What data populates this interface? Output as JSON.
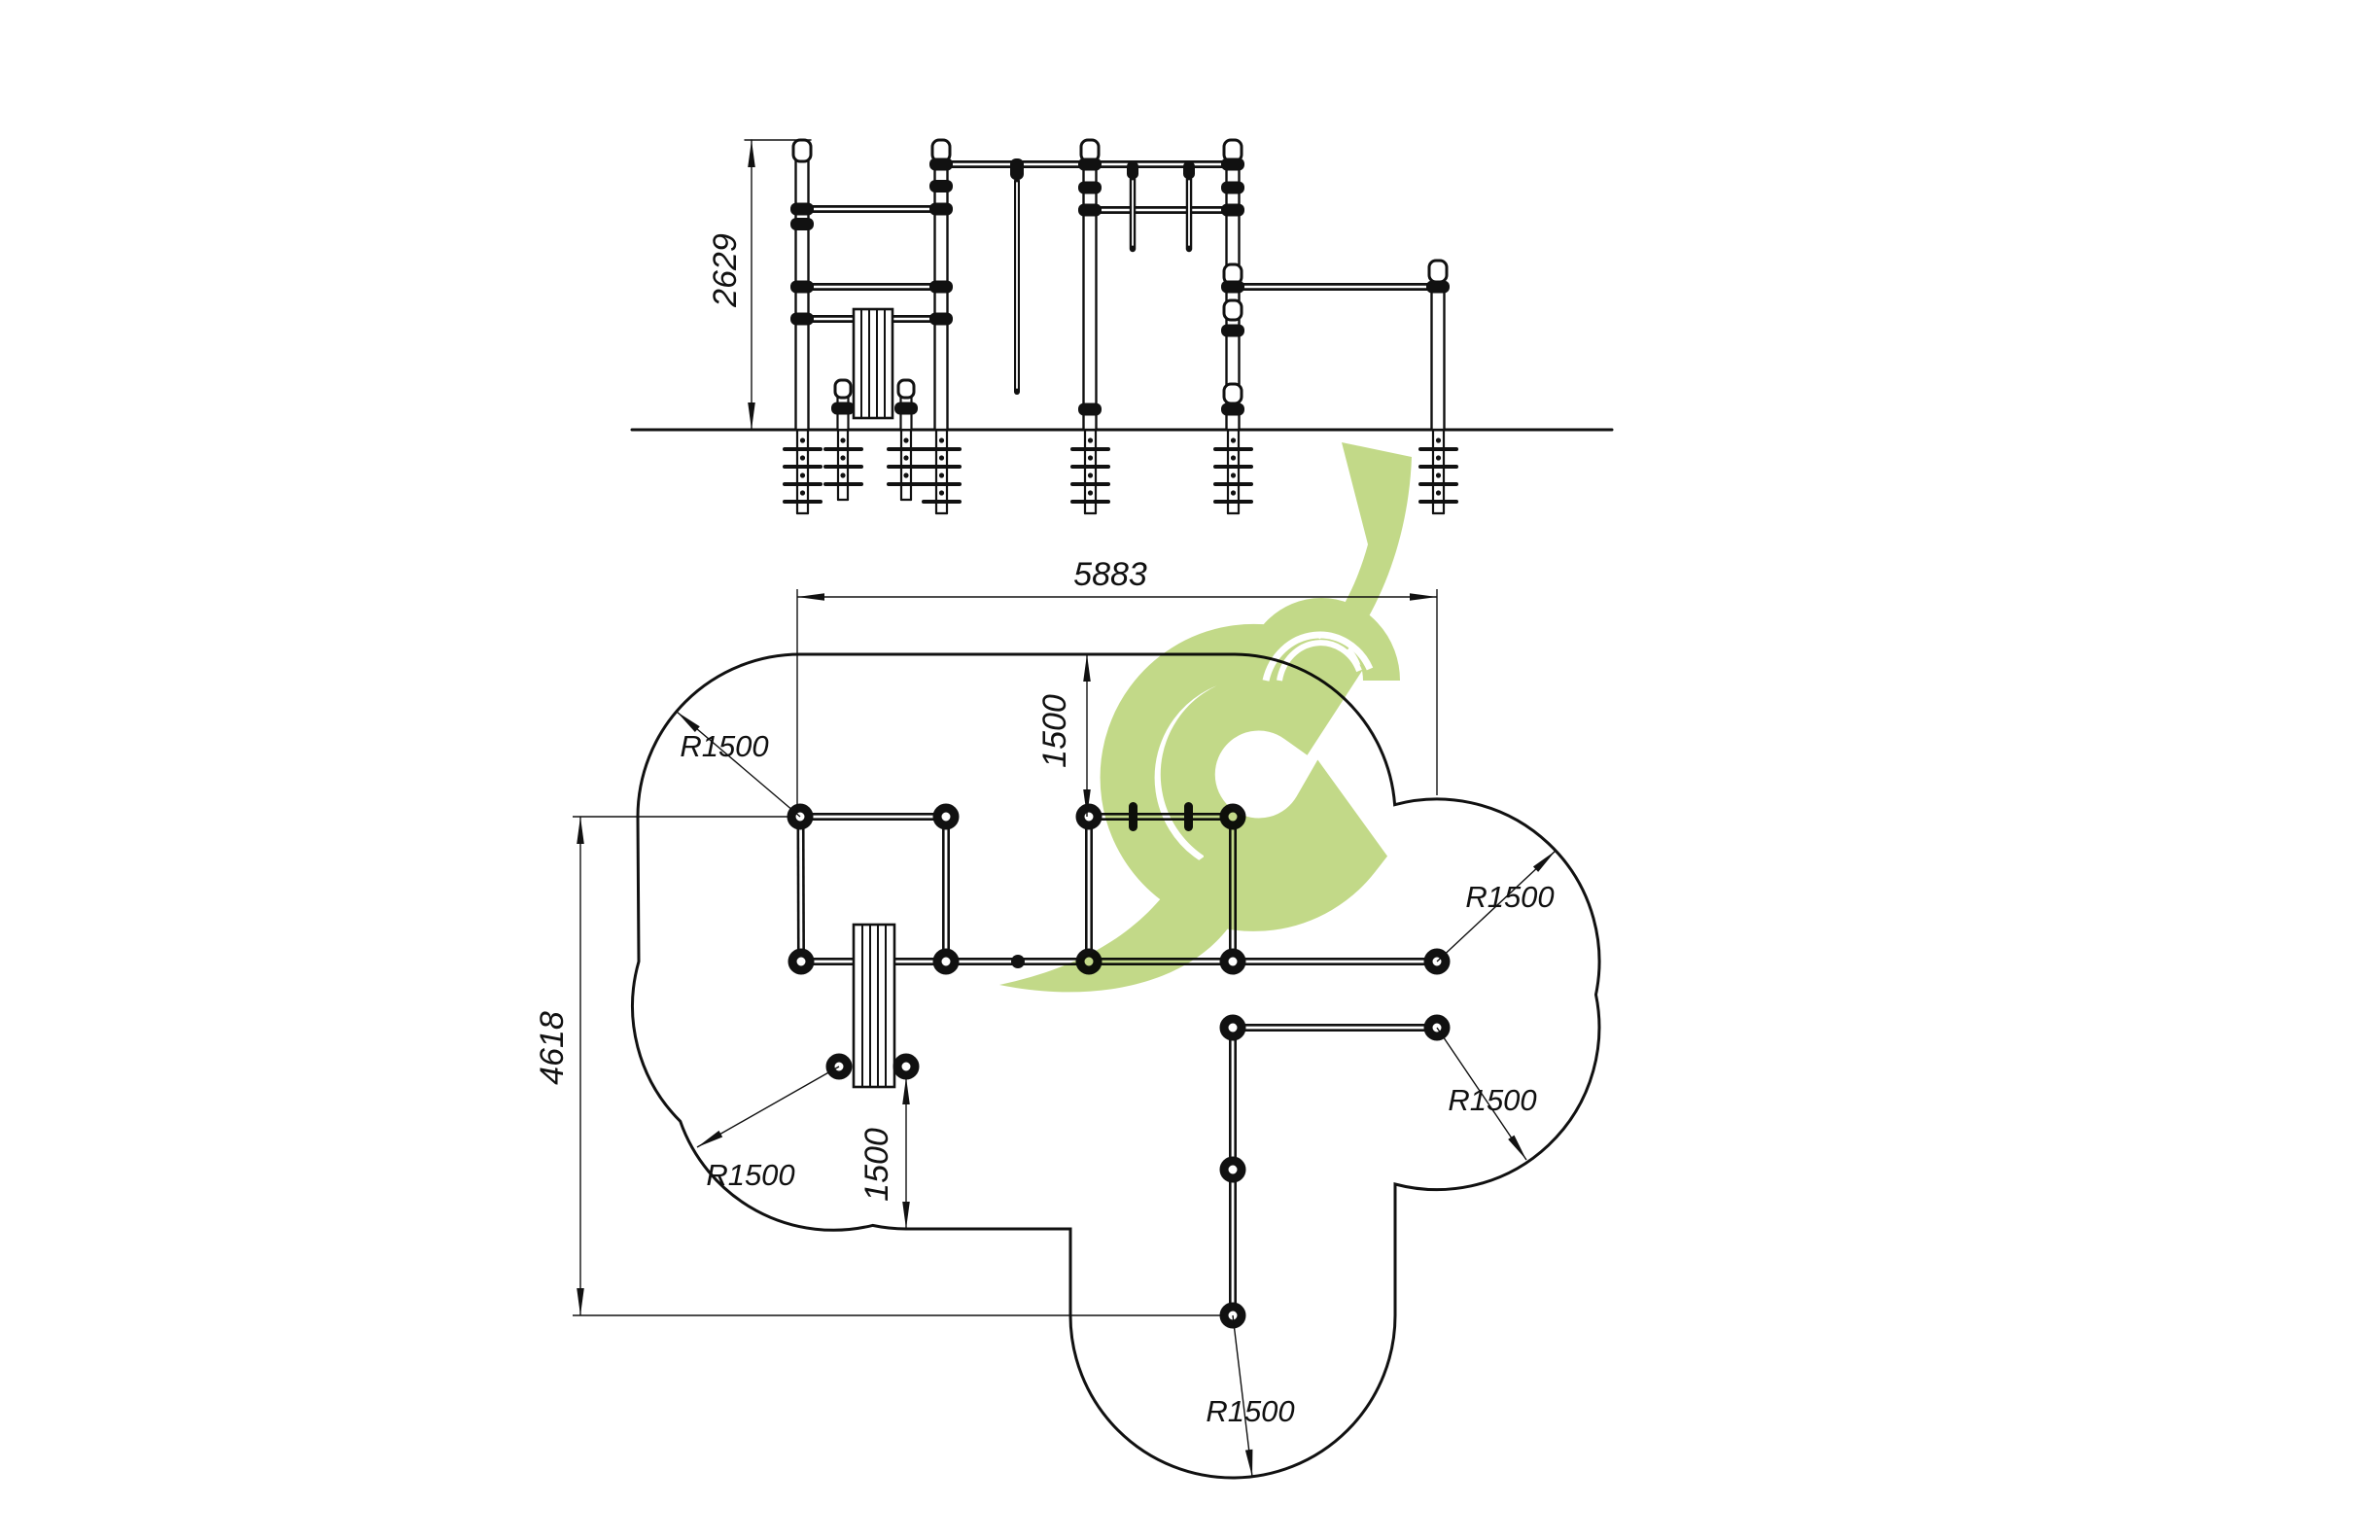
{
  "page": {
    "title": "Outdoor workout equipment - installation drawing",
    "background": "#ffffff",
    "line_color": "#111111",
    "logo_color": "#9dc23e"
  },
  "elevation_view": {
    "dim_height": "2629"
  },
  "plan_view": {
    "dim_width": "5883",
    "dim_depth": "4618",
    "dim_offset_top": "1500",
    "dim_offset_bottom": "1500",
    "radius_top_left": "R1500",
    "radius_bench": "R1500",
    "radius_right_upper": "R1500",
    "radius_right_lower": "R1500",
    "radius_bottom": "R1500"
  }
}
